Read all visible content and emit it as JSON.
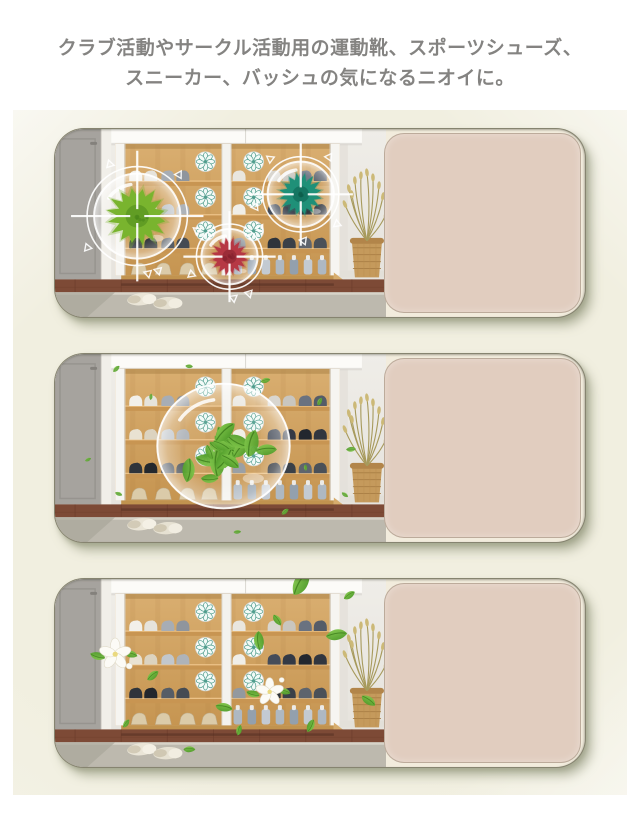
{
  "page": {
    "heading": {
      "line1": "クラブ活動やサークル活動用の運動靴、スポーツシューズ、",
      "line2": "スニーカー、バッシュの気になるニオイに。"
    },
    "colors": {
      "page_bg": "#ffffff",
      "section_bg": "#f2f0e2",
      "card_panel_bg": "#e1cdbf",
      "card_border": "#58584a",
      "heading_text": "#29282593",
      "germ_green": "#79b42e",
      "germ_teal": "#1f9078",
      "germ_red": "#b63844",
      "leaf_green": "#3e8d1e",
      "disc_teal": "#4f9d8d",
      "wood": "#d0a264",
      "floor": "#7d4a36",
      "rug": "#bdb9ae"
    },
    "panels": [
      {
        "id": "odor-germs",
        "overlay": "germ-targets",
        "description": "shoe-cabinet-with-odor-germs-targeted"
      },
      {
        "id": "deodorizing-action",
        "overlay": "leaf-bubble",
        "description": "shoe-cabinet-with-green-leaf-bubble"
      },
      {
        "id": "fresh-result",
        "overlay": "fresh-leaves-flowers",
        "description": "shoe-cabinet-fresh-with-leaves-and-flowers"
      }
    ]
  }
}
